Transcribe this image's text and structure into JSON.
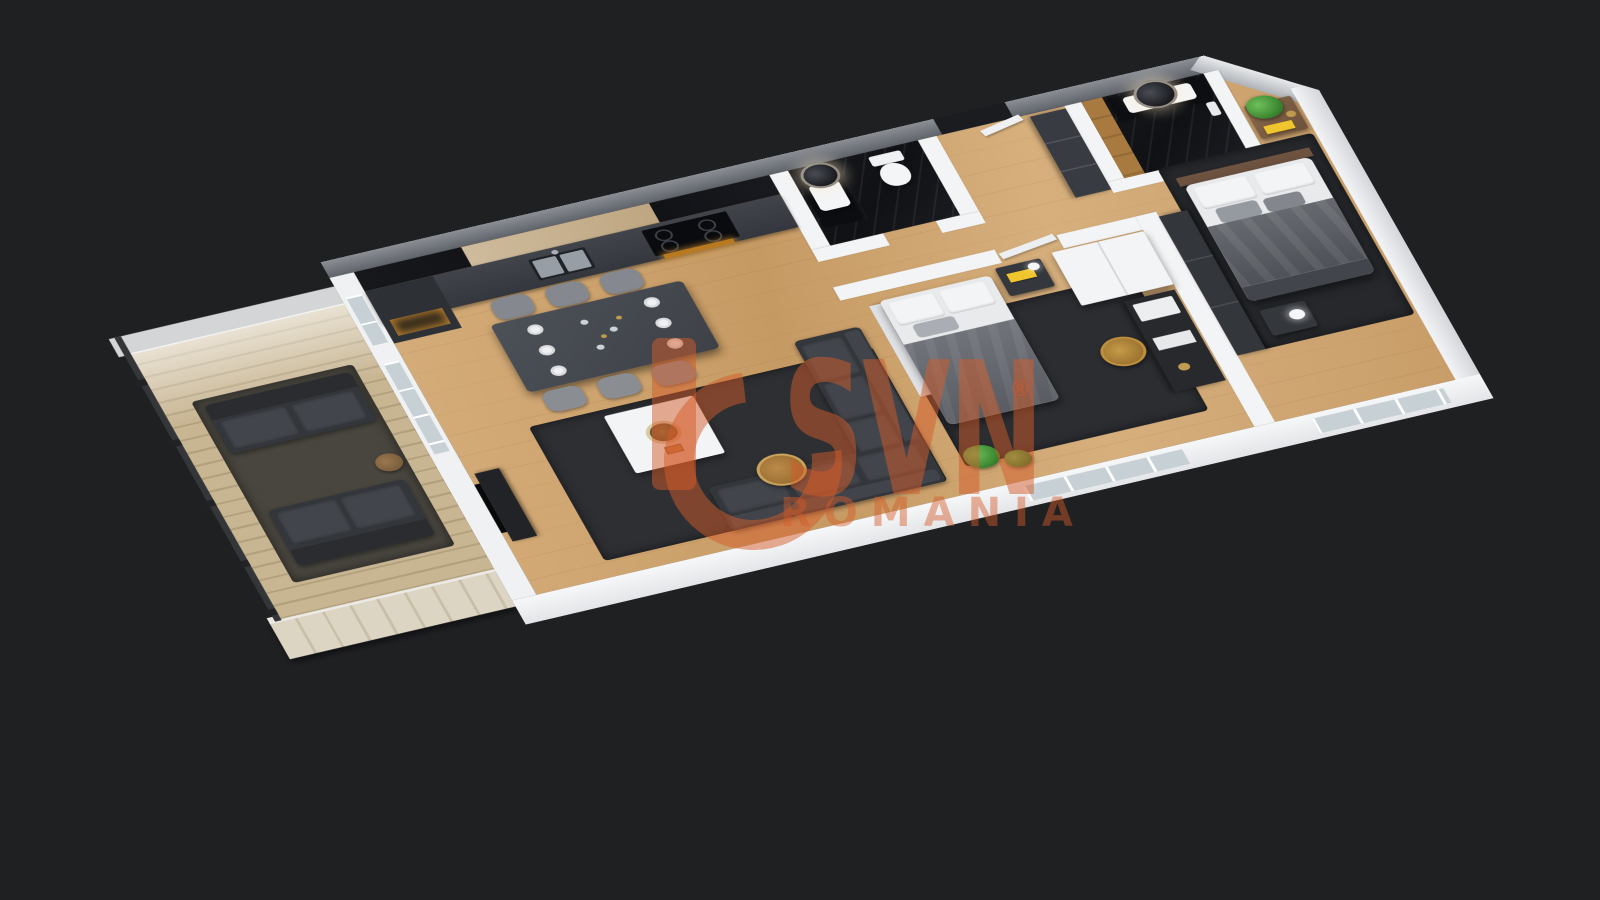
{
  "scene": {
    "description": "3D isometric cutaway floor plan rendering of a two-bedroom apartment with balcony, shown on a dark charcoal background",
    "view": "axonometric top-down, rotated about -14 degrees",
    "background_color": "#1f2022"
  },
  "watermark": {
    "brand": "SVN",
    "registered_symbol": "®",
    "region": "ROMANIA",
    "color": "#d35c2a"
  },
  "palette": {
    "bg": "#1f2022",
    "wood_floor": "#cda56f",
    "deck_wood": "#c8b592",
    "wall_white": "#f3f4f6",
    "wall_gray_top": "#8b8f95",
    "kitchen_cabinet": "#3a3d43",
    "black_marble": "#131418",
    "rug_dark": "#2d2f33",
    "sofa_dark": "#33363b",
    "bed_linen": "#e9eaec",
    "blanket_gray": "#65686e",
    "accent_gold": "#c09a4f",
    "accent_yellow": "#f0c62e",
    "plant_green": "#3f8c34",
    "glass": "#c6d0d5",
    "oven_amber": "#c98a2f"
  },
  "rooms": [
    {
      "name": "balcony",
      "floor": "light wood deck",
      "items": [
        "outdoor sofa",
        "outdoor loveseat",
        "dark shag rug",
        "side table",
        "metal railing",
        "frosted glass screen"
      ]
    },
    {
      "name": "living-room",
      "floor": "oak wood",
      "items": [
        "L-shaped dark sectional sofa",
        "white square coffee table with gold bowl",
        "round gold side table",
        "dark rug",
        "TV unit on left wall"
      ]
    },
    {
      "name": "dining-area",
      "floor": "oak wood",
      "items": [
        "dark rectangular table",
        "six gray chairs",
        "white place settings",
        "glassware"
      ]
    },
    {
      "name": "kitchen",
      "floor": "oak wood",
      "items": [
        "dark gray cabinet run",
        "black marble backsplash",
        "light wood upper cabinets",
        "double steel sink",
        "induction cooktop",
        "oven with amber glow",
        "lit shelf niche"
      ]
    },
    {
      "name": "bathroom-1",
      "floor": "black marble",
      "items": [
        "backlit round mirror",
        "white vessel sink on dark vanity",
        "toilet"
      ]
    },
    {
      "name": "hallway-entrance",
      "floor": "oak wood",
      "items": [
        "entrance door",
        "white open door leaf",
        "dark built-in closets"
      ]
    },
    {
      "name": "bathroom-2",
      "floor": "black marble",
      "items": [
        "backlit round mirror",
        "white double sink",
        "wood accent wall strip",
        "chamfered exterior corner"
      ]
    },
    {
      "name": "bedroom",
      "floor": "oak wood",
      "items": [
        "double bed with gray blanket and white pillows",
        "nightstand with yellow book and lamp",
        "dark rug",
        "desk with white printer and papers",
        "gold office chair",
        "white-top wardrobe",
        "floor plants",
        "window"
      ]
    },
    {
      "name": "master-bedroom",
      "floor": "oak wood",
      "items": [
        "double bed with gray blanket and white pillows",
        "wood headboard",
        "corner nightstand with green plant and yellow book",
        "nightstand with white lamp",
        "dark wardrobe row",
        "dark rug",
        "window"
      ]
    }
  ]
}
